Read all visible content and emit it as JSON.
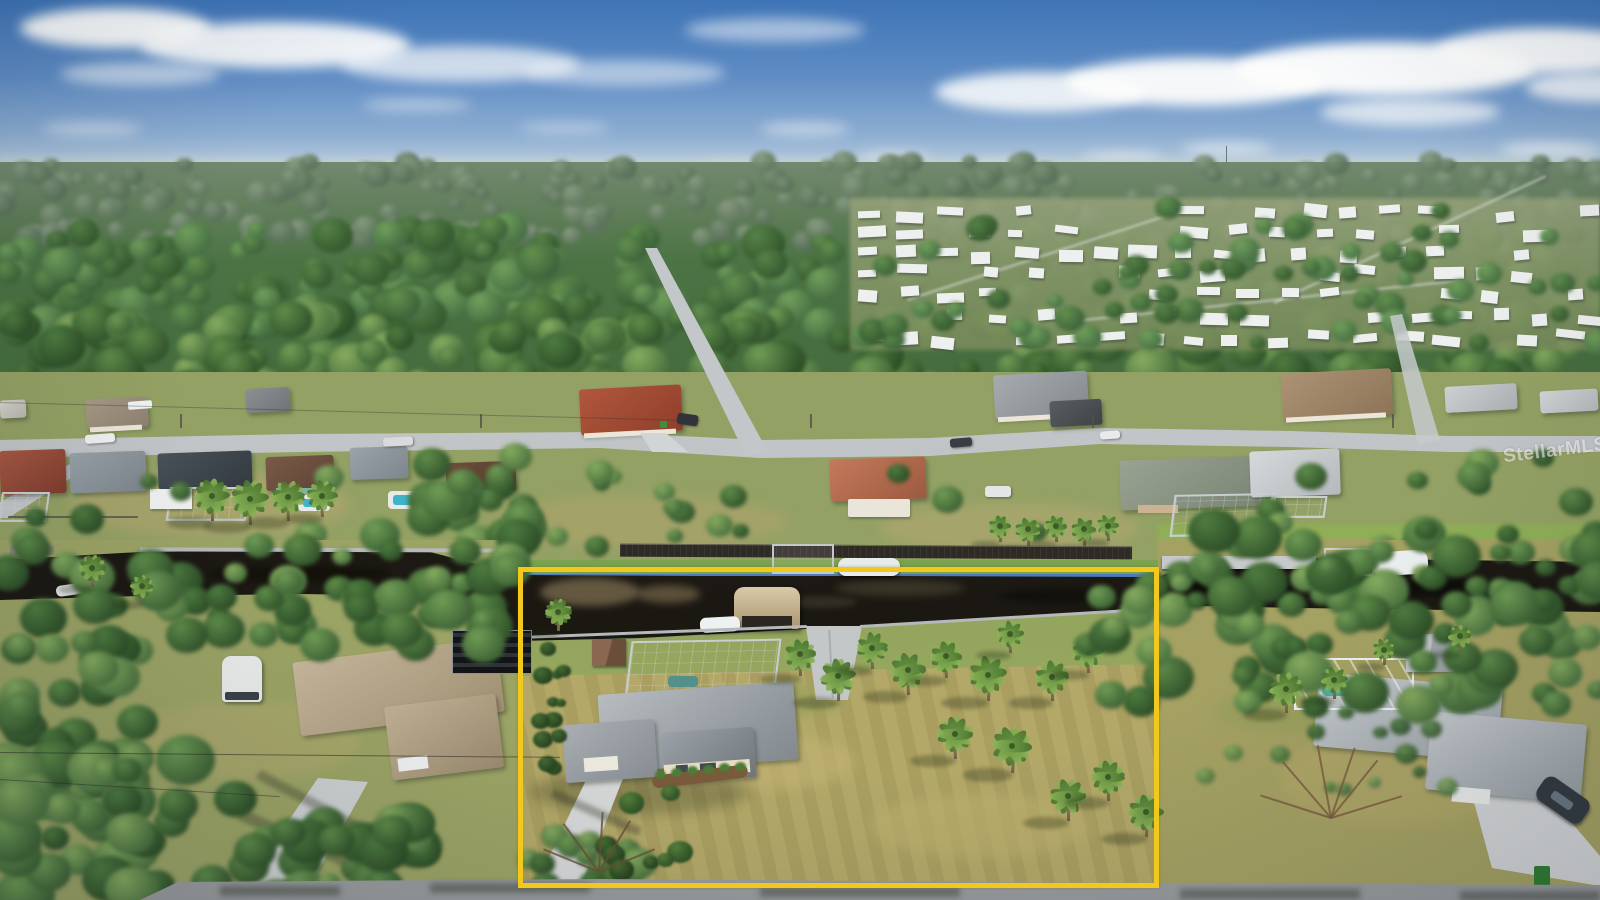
{
  "photo": {
    "watermark": "StellarMLS",
    "scene": "aerial-neighborhood-canal-waterfront",
    "annotation": {
      "type": "property-boundary-rectangle",
      "color": "#F2C81D"
    },
    "palette": {
      "boundary_yellow": "#F2C81D",
      "sky_blue": "#3E74B6",
      "canal_water": "#1E1A14",
      "lawn_tan": "#B1A765",
      "foliage_green": "#4E7C40",
      "roof_gray": "#9AA0A6",
      "road_gray": "#C6CACC"
    }
  }
}
